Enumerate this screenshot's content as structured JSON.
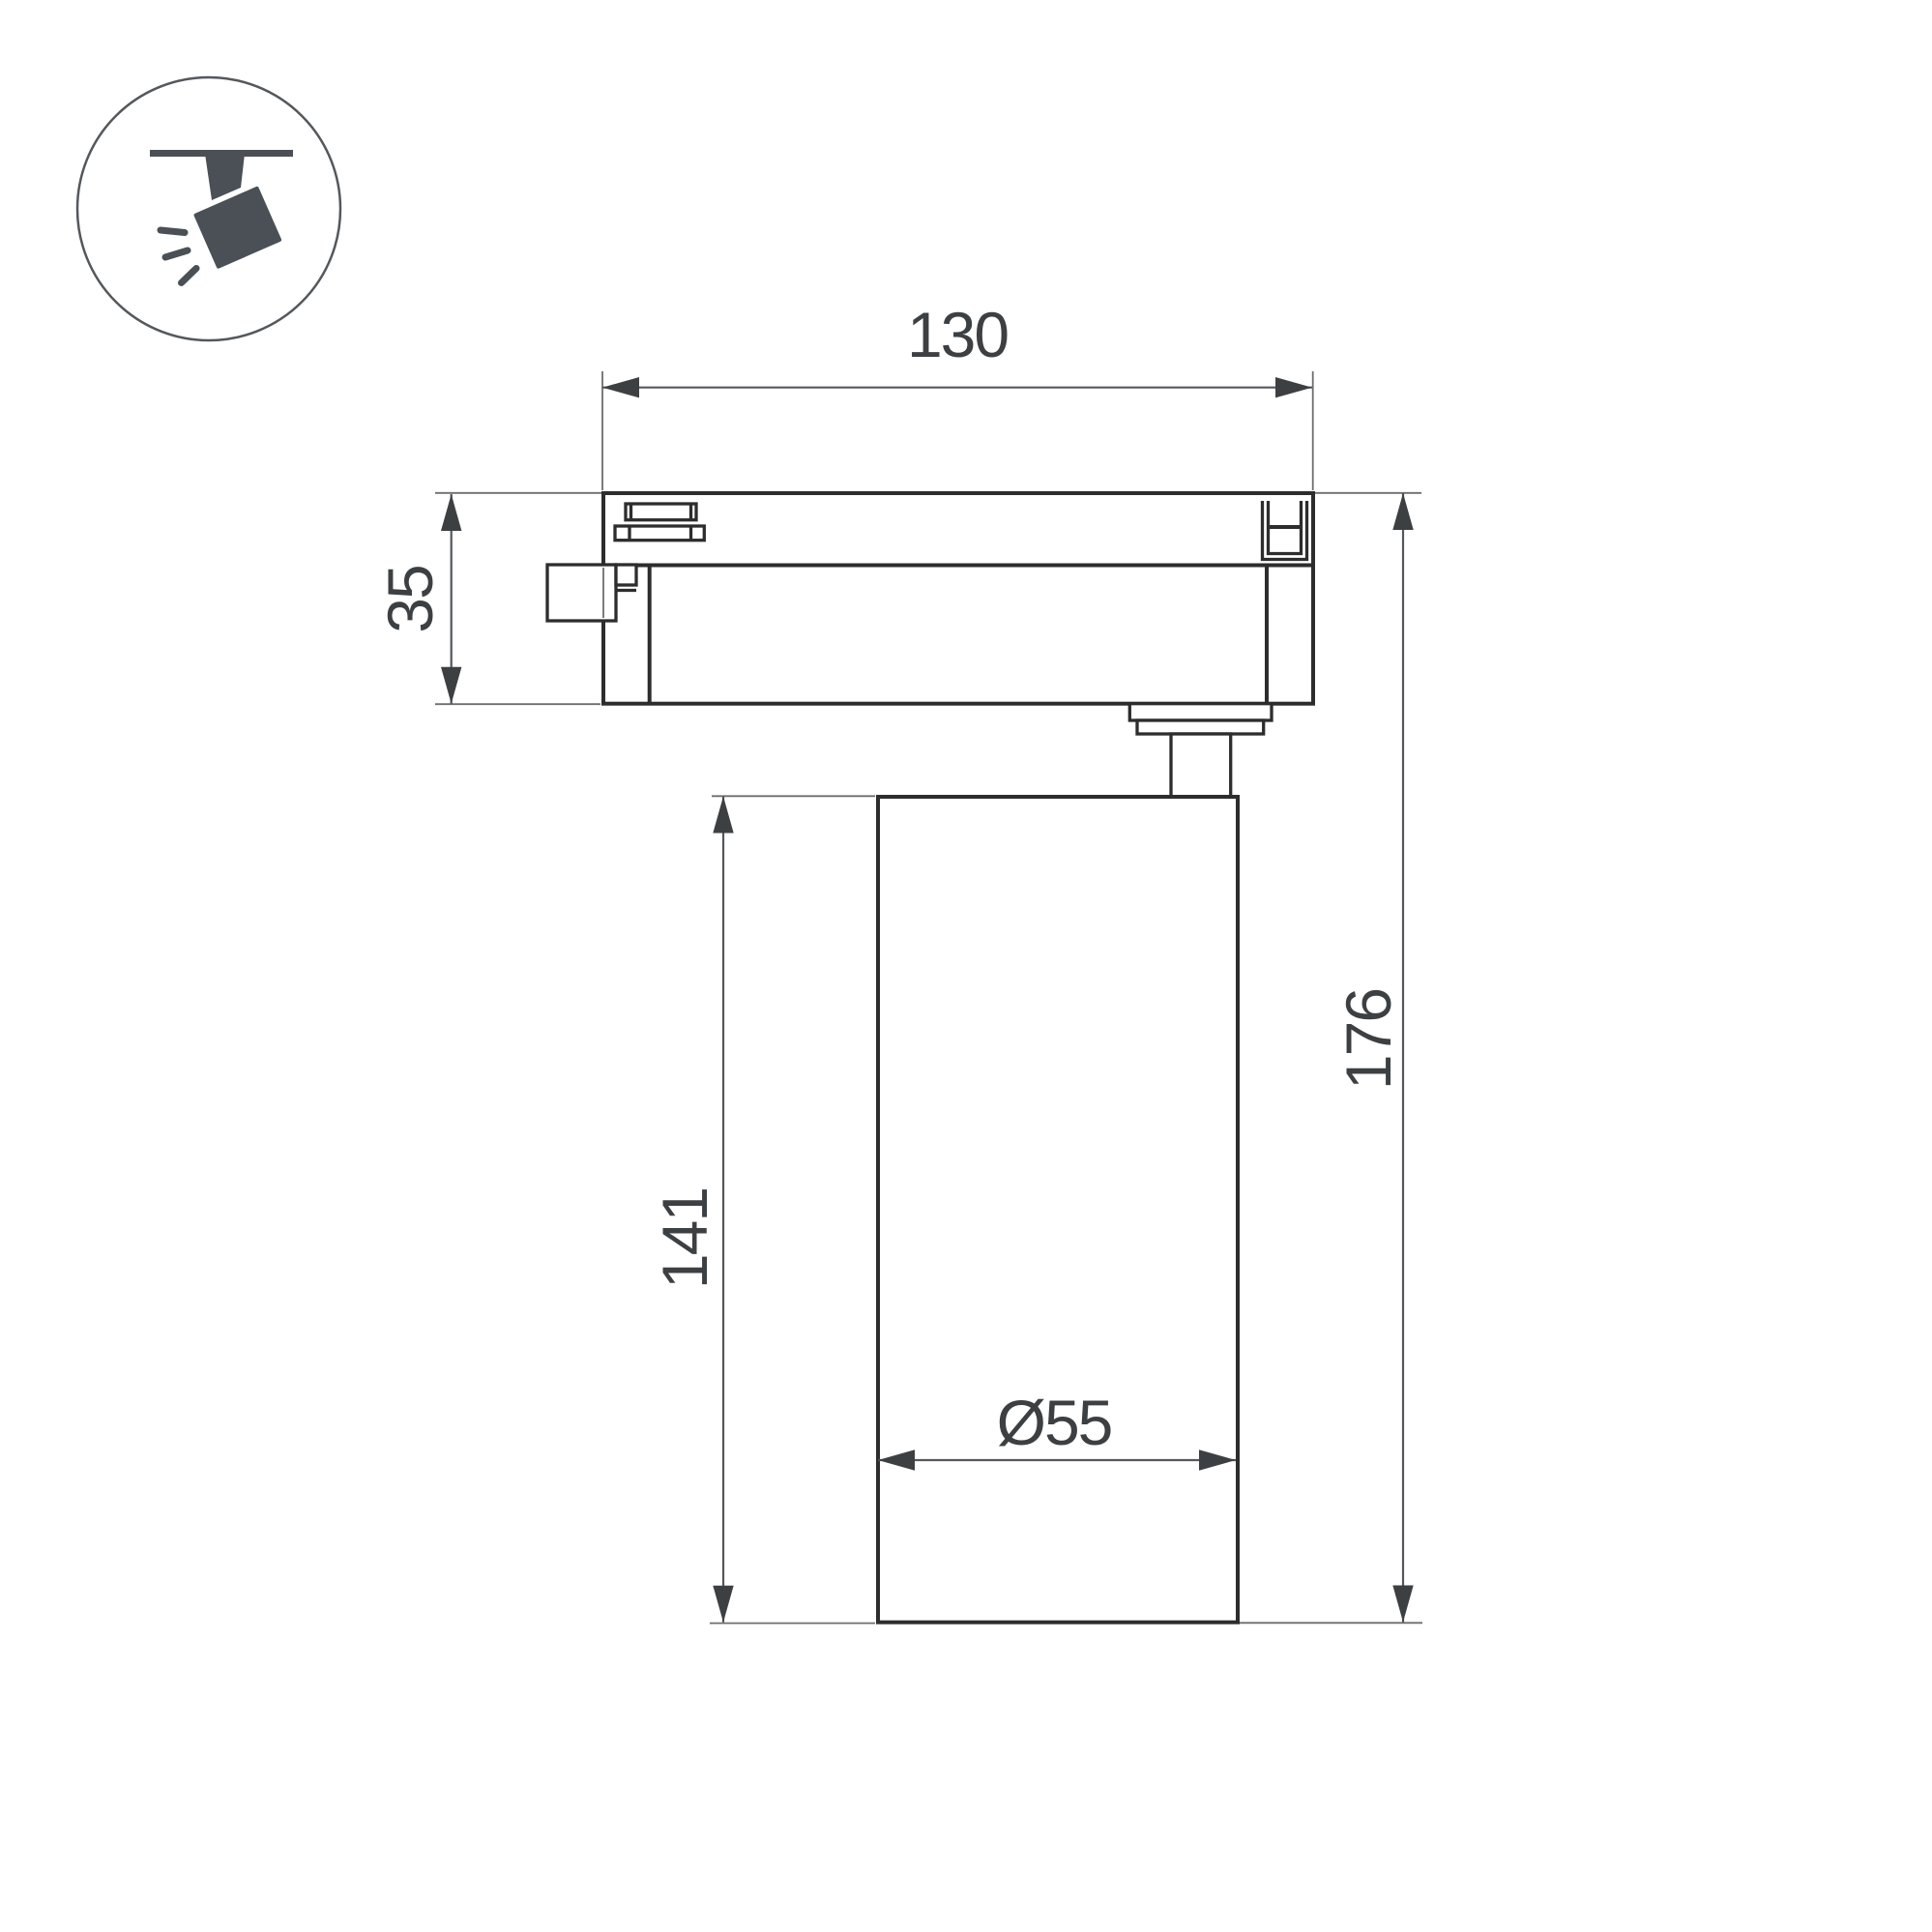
{
  "title": "Track spotlight dimensional drawing",
  "icon": {
    "name": "track-spotlight-icon"
  },
  "dimensions": {
    "width_top": "130",
    "track_adapter_height": "35",
    "body_height": "141",
    "total_height": "176",
    "body_diameter": "Ø55"
  },
  "colors": {
    "outline": "#2d2d2d",
    "dimension": "#54575b",
    "text": "#3c4043",
    "icon": "#4a5055",
    "background": "#ffffff"
  }
}
